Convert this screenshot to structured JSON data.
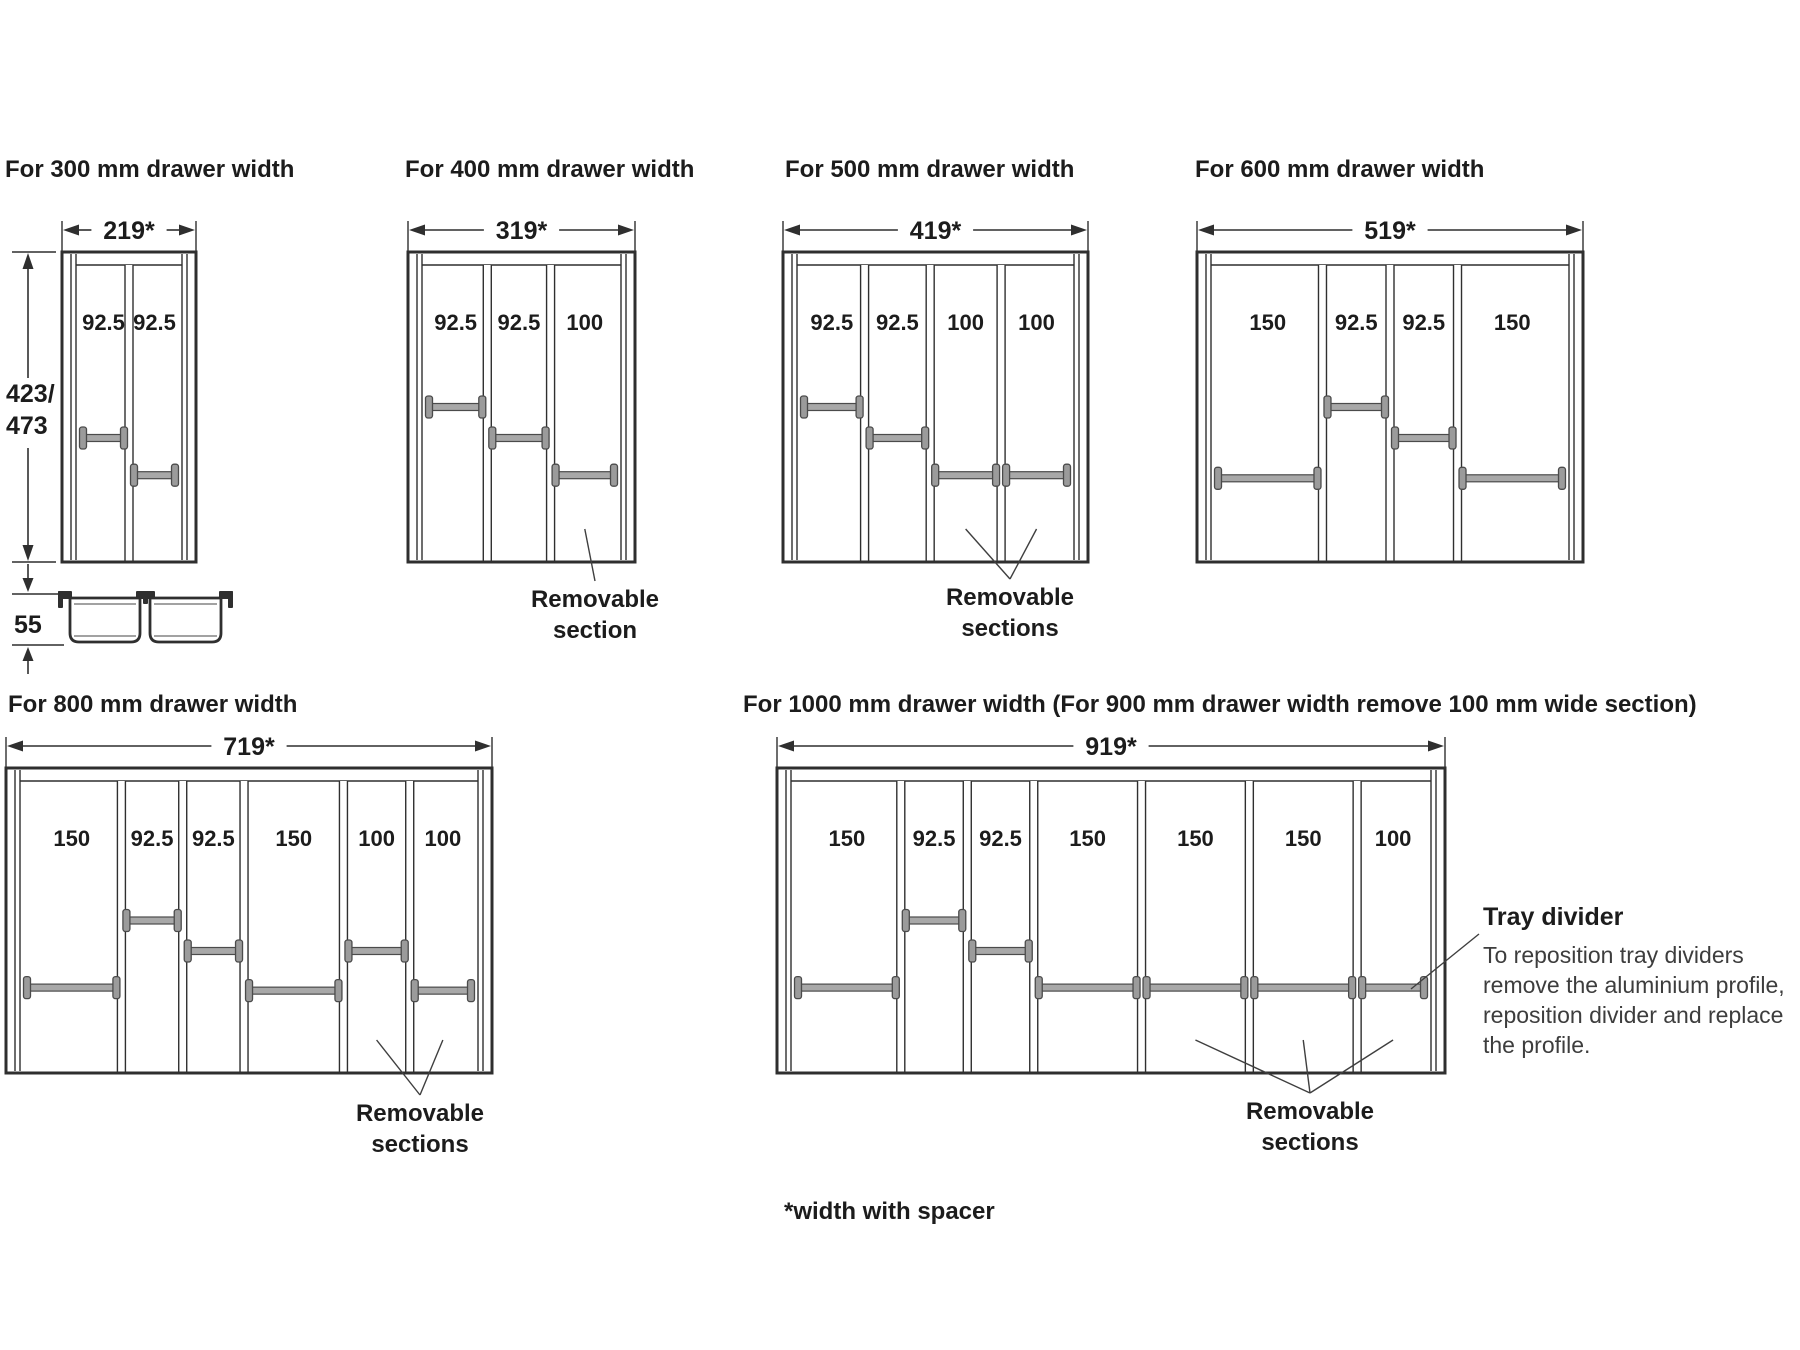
{
  "diagrams": [
    {
      "title": "For 300 mm drawer width",
      "width_dim": "219*",
      "sections": [
        {
          "width_mm": "92.5",
          "divider_pos": 0.6
        },
        {
          "width_mm": "92.5",
          "divider_pos": 0.72
        }
      ],
      "annotation": null
    },
    {
      "title": "For 400 mm drawer width",
      "width_dim": "319*",
      "sections": [
        {
          "width_mm": "92.5",
          "divider_pos": 0.5
        },
        {
          "width_mm": "92.5",
          "divider_pos": 0.6
        },
        {
          "width_mm": "100",
          "divider_pos": 0.72
        }
      ],
      "annotation": {
        "lines": [
          "Removable",
          "section"
        ],
        "targets": [
          2
        ]
      }
    },
    {
      "title": "For 500 mm drawer width",
      "width_dim": "419*",
      "sections": [
        {
          "width_mm": "92.5",
          "divider_pos": 0.5
        },
        {
          "width_mm": "92.5",
          "divider_pos": 0.6
        },
        {
          "width_mm": "100",
          "divider_pos": 0.72
        },
        {
          "width_mm": "100",
          "divider_pos": 0.72
        }
      ],
      "annotation": {
        "lines": [
          "Removable",
          "sections"
        ],
        "targets": [
          2,
          3
        ]
      }
    },
    {
      "title": "For 600 mm drawer width",
      "width_dim": "519*",
      "sections": [
        {
          "width_mm": "150",
          "divider_pos": 0.73
        },
        {
          "width_mm": "92.5",
          "divider_pos": 0.5
        },
        {
          "width_mm": "92.5",
          "divider_pos": 0.6
        },
        {
          "width_mm": "150",
          "divider_pos": 0.73
        }
      ],
      "annotation": null
    },
    {
      "title": "For 800 mm drawer width",
      "width_dim": "719*",
      "sections": [
        {
          "width_mm": "150",
          "divider_pos": 0.72
        },
        {
          "width_mm": "92.5",
          "divider_pos": 0.5
        },
        {
          "width_mm": "92.5",
          "divider_pos": 0.6
        },
        {
          "width_mm": "150",
          "divider_pos": 0.73
        },
        {
          "width_mm": "100",
          "divider_pos": 0.6
        },
        {
          "width_mm": "100",
          "divider_pos": 0.73
        }
      ],
      "annotation": {
        "lines": [
          "Removable",
          "sections"
        ],
        "targets": [
          4,
          5
        ]
      }
    },
    {
      "title": "For 1000 mm drawer width (For 900 mm drawer width remove 100 mm wide section)",
      "width_dim": "919*",
      "sections": [
        {
          "width_mm": "150",
          "divider_pos": 0.72
        },
        {
          "width_mm": "92.5",
          "divider_pos": 0.5
        },
        {
          "width_mm": "92.5",
          "divider_pos": 0.6
        },
        {
          "width_mm": "150",
          "divider_pos": 0.72
        },
        {
          "width_mm": "150",
          "divider_pos": 0.72
        },
        {
          "width_mm": "150",
          "divider_pos": 0.72
        },
        {
          "width_mm": "100",
          "divider_pos": 0.72
        }
      ],
      "annotation": {
        "lines": [
          "Removable",
          "sections"
        ],
        "targets": [
          4,
          5,
          6
        ]
      }
    }
  ],
  "depth_dim": {
    "lines": [
      "423/",
      "473"
    ]
  },
  "side_profile": {
    "height_label": "55"
  },
  "note": {
    "title": "Tray divider",
    "body": "To reposition tray dividers remove the aluminium profile, reposition divider and replace the profile."
  },
  "footnote": "*width with spacer",
  "colors": {
    "line": "#2f2f2f",
    "leader": "#3f3f3f",
    "bar_fill": "#a8a8a8",
    "bar_cap_fill": "#9b9b9b",
    "bar_stroke": "#4b4b4b",
    "text": "#1c1c1c"
  }
}
